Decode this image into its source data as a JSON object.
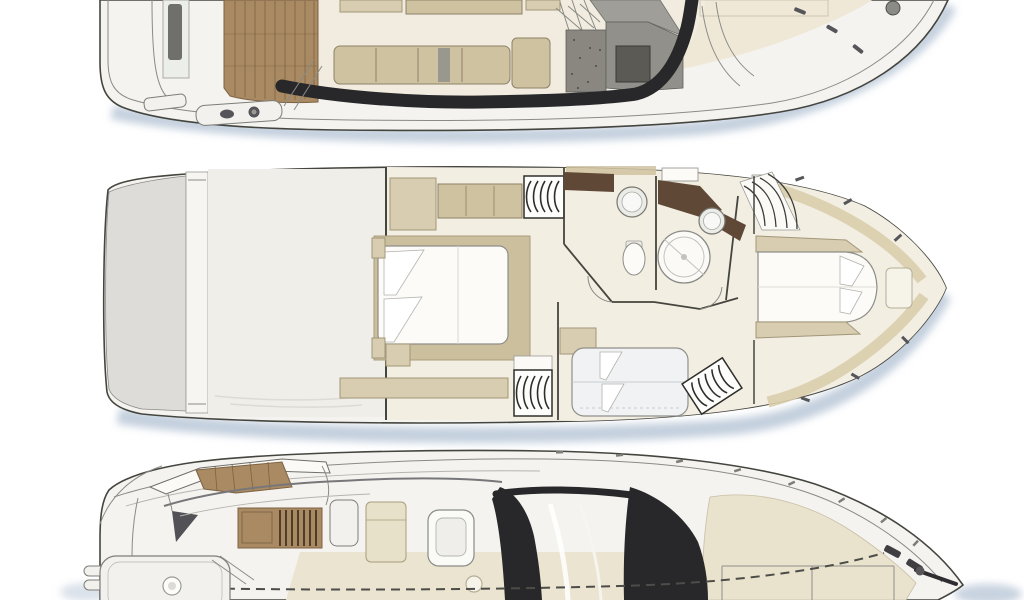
{
  "canvas": {
    "width": 1024,
    "height": 600
  },
  "palette": {
    "background": "#ffffff",
    "outline": "#45453f",
    "hull_fill": "#f4f3ef",
    "deck_cream": "#f1ecdf",
    "teak": "#a98a62",
    "teak_line": "#7d6344",
    "furniture_beige": "#cfc2a1",
    "furniture_tan": "#d8cdb0",
    "glazing_dark": "#28282a",
    "galley_gray": "#8a8781",
    "shadow_blue": "#b5c4d5",
    "brown_counter": "#5f4936",
    "wall_line": "#45453f",
    "fixture_white": "#fcfbf8"
  },
  "figures": [
    {
      "label": "main deck plan with teak cockpit, salon sofa, galley and bow walkway (cropped at top)"
    },
    {
      "label": "lower deck plan with midship master cabin, two bathrooms, twin berth cabin and bow VIP cabin"
    },
    {
      "label": "flybridge and foredeck exterior view with radar arch, helm, dark windshield and swim platform (cropped at bottom)"
    }
  ]
}
